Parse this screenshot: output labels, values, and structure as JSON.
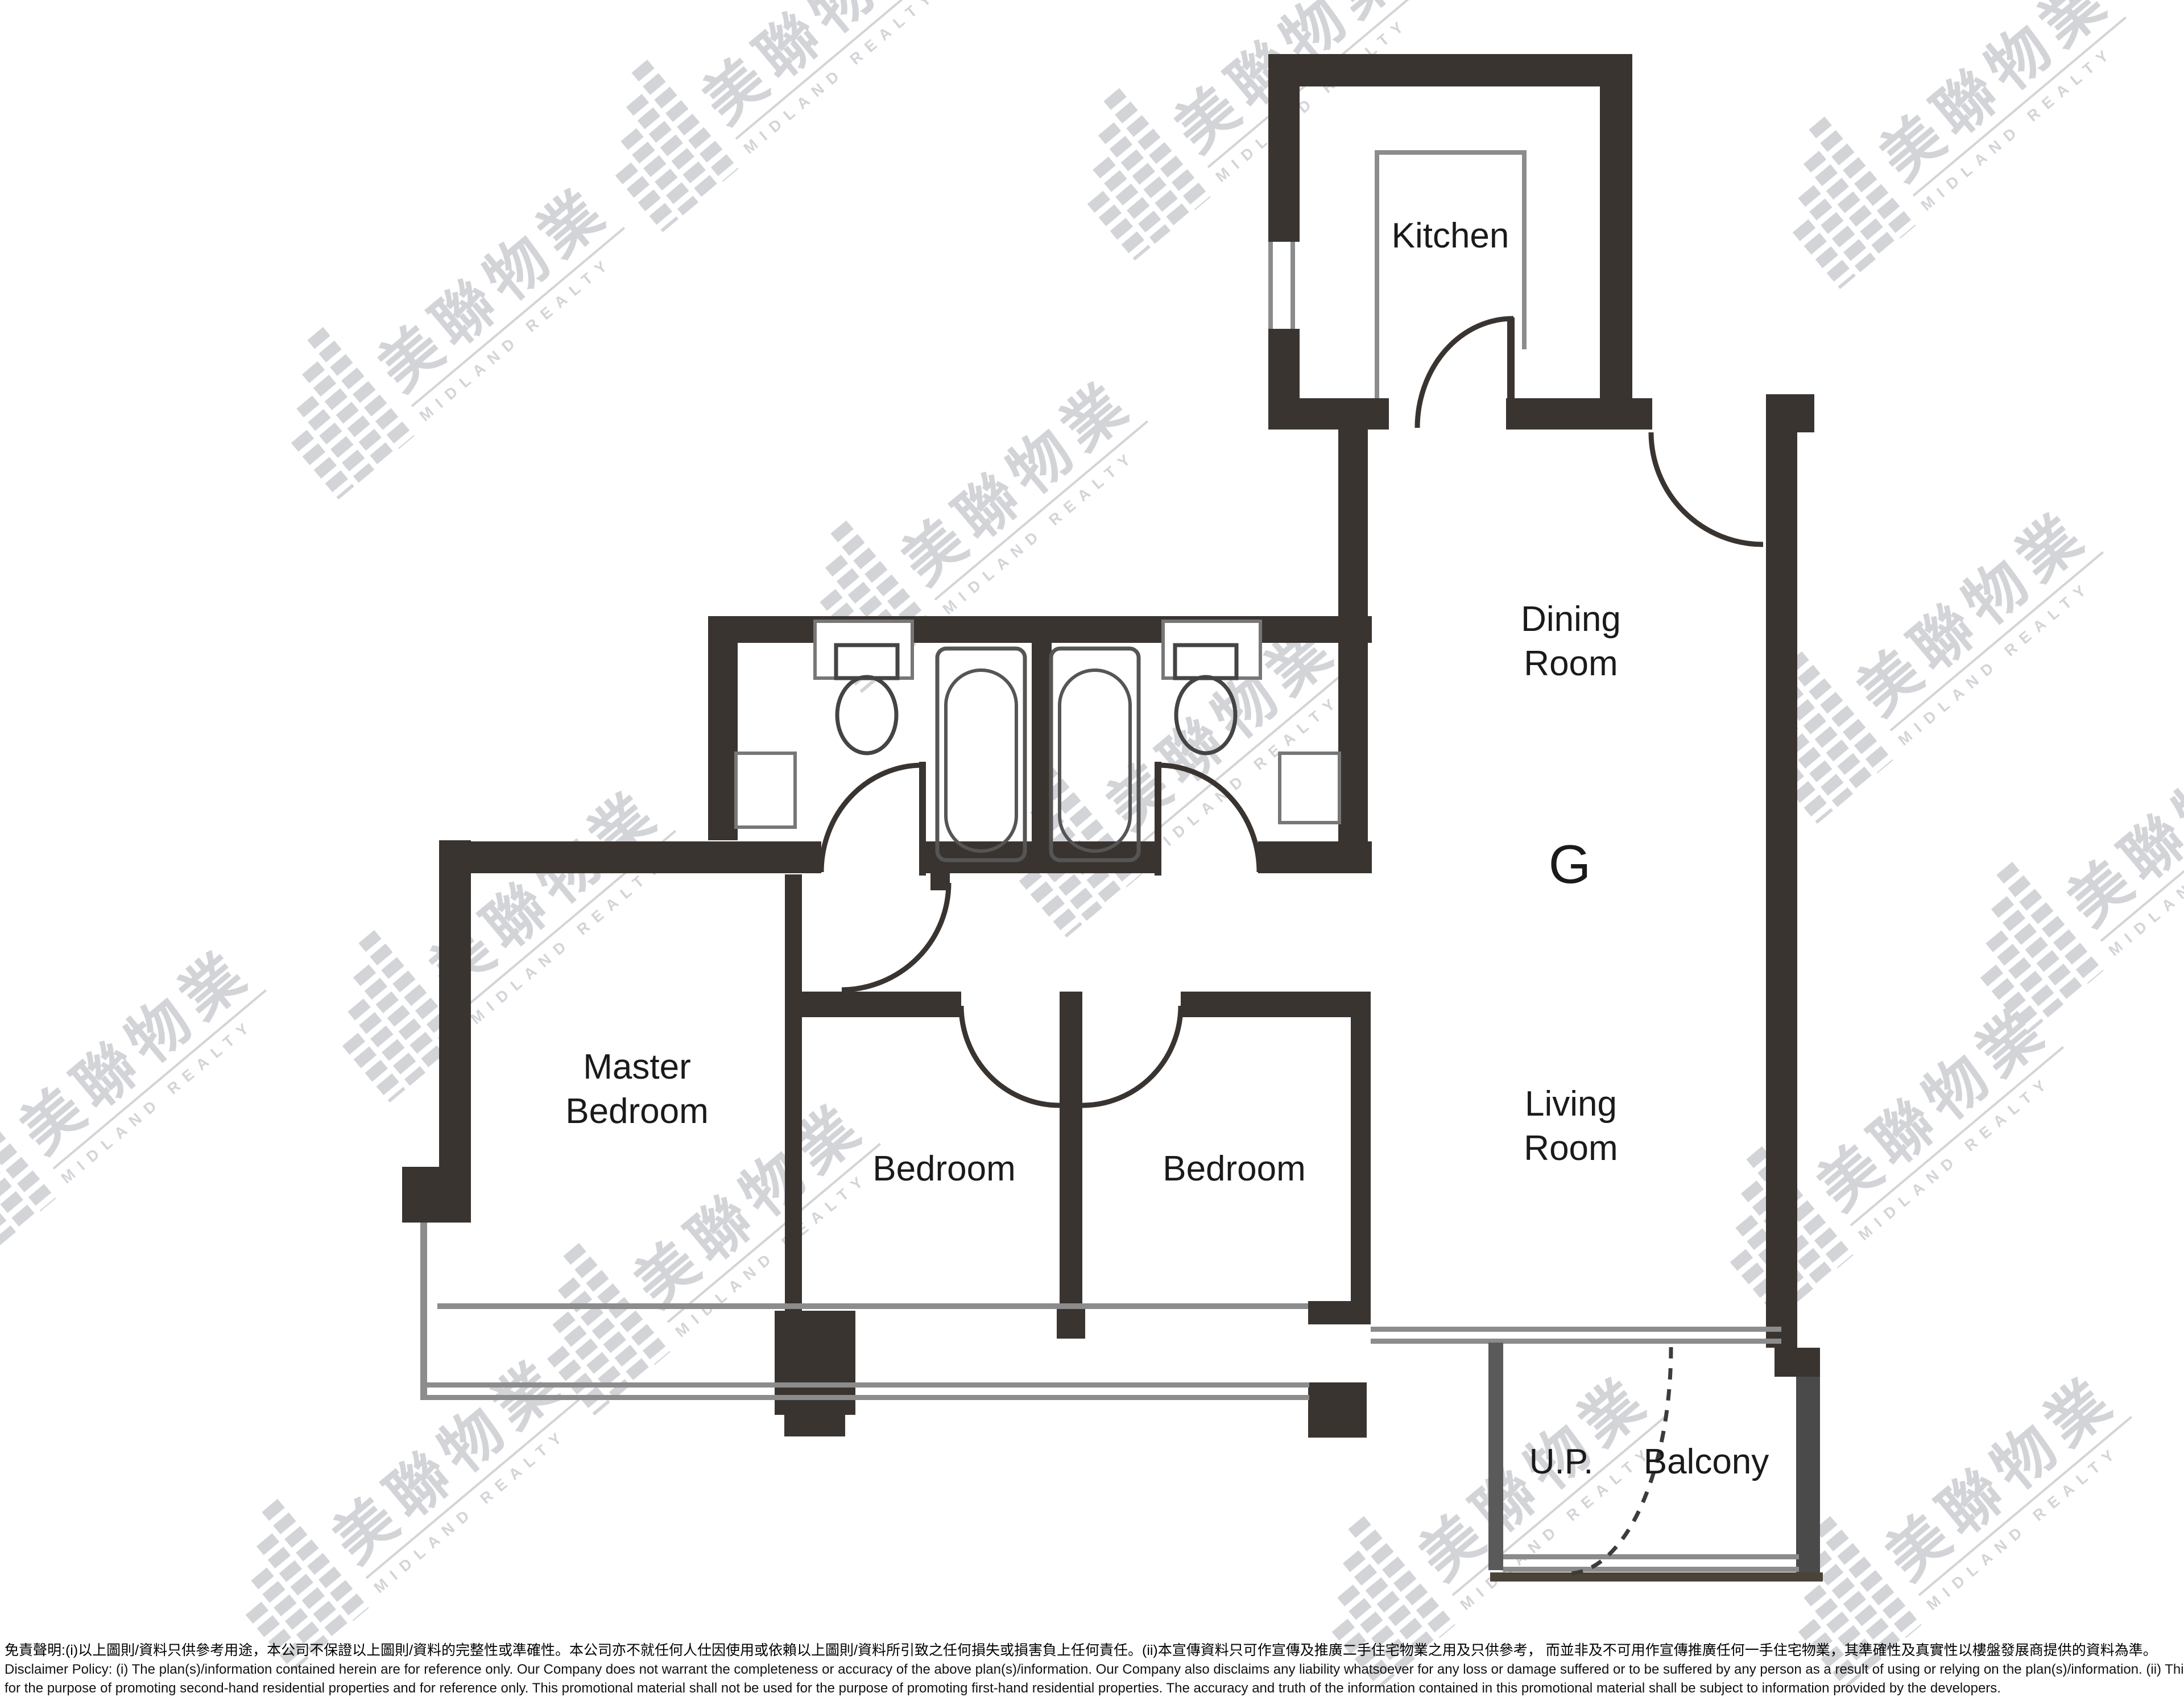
{
  "document": {
    "type": "residential floor plan",
    "unit_label": "G"
  },
  "rooms": {
    "kitchen": {
      "label": "Kitchen"
    },
    "dining_room": {
      "line1": "Dining",
      "line2": "Room"
    },
    "living_room": {
      "line1": "Living",
      "line2": "Room"
    },
    "master_bedroom": {
      "line1": "Master",
      "line2": "Bedroom"
    },
    "bedroom_1": {
      "label": "Bedroom"
    },
    "bedroom_2": {
      "label": "Bedroom"
    },
    "balcony": {
      "label": "Balcony"
    },
    "utility_platform": {
      "label": "U.P."
    }
  },
  "watermark": {
    "chinese": "美聯物業",
    "english": "MIDLAND REALTY",
    "color": "#d2d4d8"
  },
  "colors": {
    "wall": "#3a3430",
    "thin_line": "#8c8c8c",
    "label_text": "#1a1a1a",
    "background": "#ffffff"
  },
  "disclaimer": {
    "chinese": "免責聲明:(i)以上圖則/資料只供參考用途，本公司不保證以上圖則/資料的完整性或準確性。本公司亦不就任何人仕因使用或依賴以上圖則/資料所引致之任何損失或損害負上任何責任。(ii)本宣傳資料只可作宣傳及推廣二手住宅物業之用及只供參考， 而並非及不可用作宣傳推廣任何一手住宅物業，其準確性及真實性以樓盤發展商提供的資料為準。",
    "english_line1": "Disclaimer Policy: (i) The plan(s)/information contained herein are for reference only. Our Company does not warrant the completeness or accuracy of the above plan(s)/information. Our Company also disclaims any liability whatsoever for any loss or damage suffered or to be suffered by any person as a result of using or relying on the plan(s)/information. (ii) This promotional material is",
    "english_line2": "for the purpose of promoting second-hand residential properties and for reference only. This promotional material shall not be used for the purpose of promoting first-hand residential properties. The accuracy and truth of the information contained in this promotional material shall be subject to information provided by the developers."
  }
}
